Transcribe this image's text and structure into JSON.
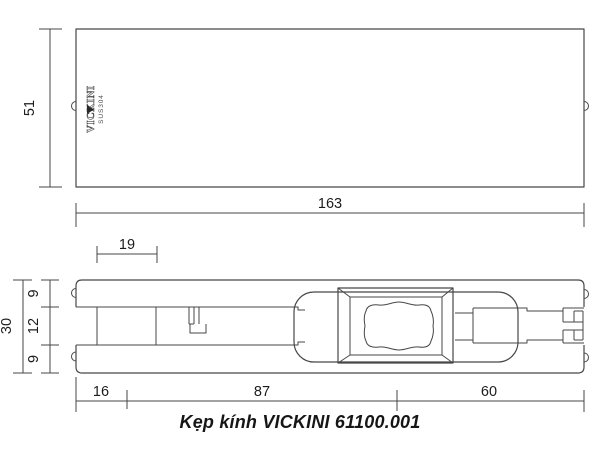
{
  "caption": "Kẹp kính VICKINI 61100.001",
  "logo": {
    "brand": "VICKINI",
    "material": "SUS304"
  },
  "dims": {
    "top_view_height": "51",
    "top_view_width": "163",
    "tab_width": "19",
    "total_thickness": "30",
    "plate_top": "9",
    "gap": "12",
    "plate_bottom": "9",
    "seg_left": "16",
    "seg_mid": "87",
    "seg_right": "60"
  },
  "colors": {
    "line": "#474747",
    "text": "#1c1c1c"
  }
}
